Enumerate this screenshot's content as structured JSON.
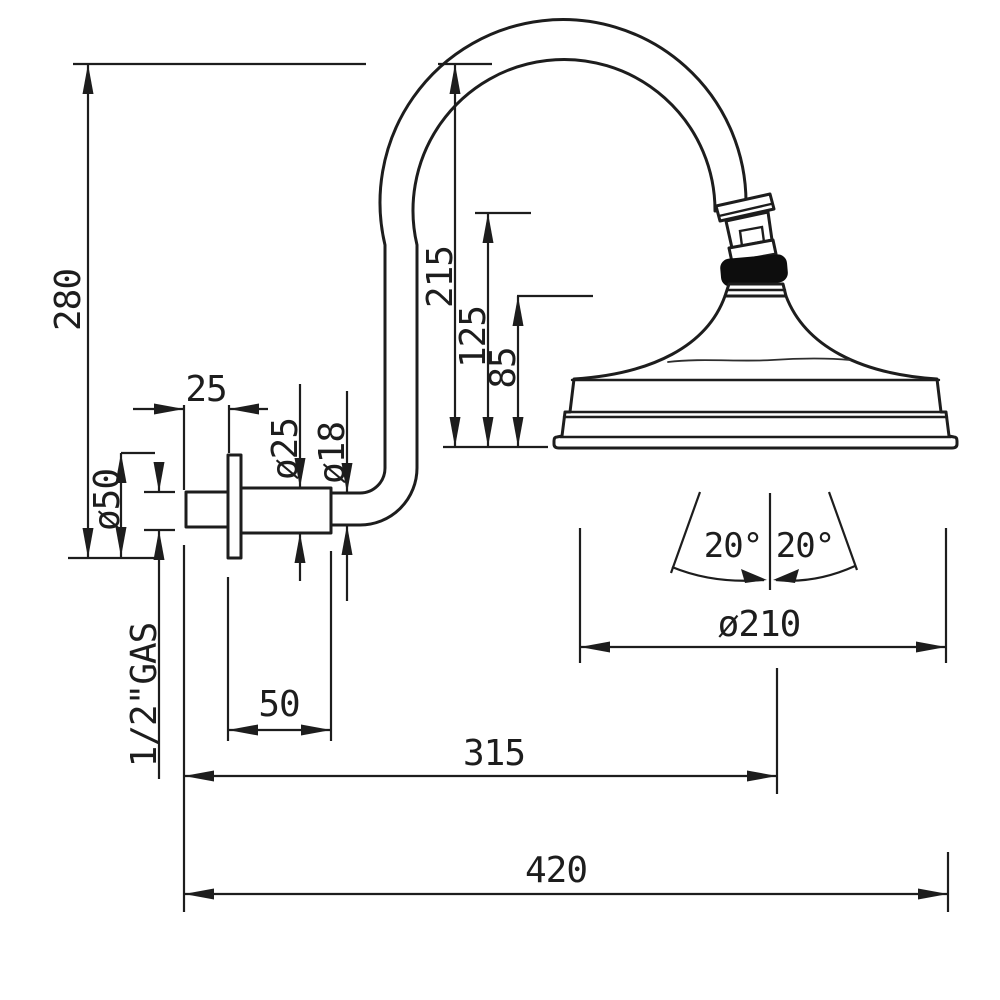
{
  "drawing": {
    "background": "#ffffff",
    "ink": "#1d1d1d",
    "description": "Technical dimension drawing (side elevation) of a wall-mounted shower head with curved gooseneck arm",
    "units": "mm"
  },
  "labels": {
    "overall_height": "280",
    "arm_top_to_face": "215",
    "connector_to_face": "125",
    "head_height": "85",
    "nipple_length": "25",
    "escutcheon_diameter": "ø25",
    "arm_pipe_diameter": "ø18",
    "flange_diameter": "ø50",
    "thread_size": "1/2\"GAS",
    "escutcheon_length": "50",
    "head_diameter": "ø210",
    "wall_to_head_center": "315",
    "overall_projection": "420",
    "spray_angle_left": "20°",
    "spray_angle_right": "20°"
  }
}
